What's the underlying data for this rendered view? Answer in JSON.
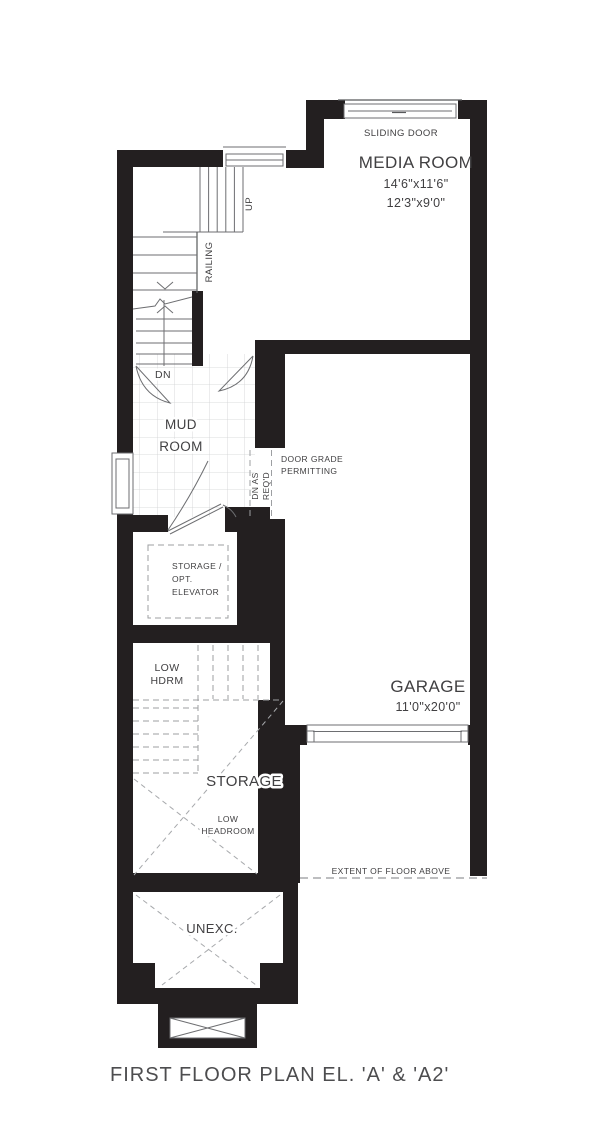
{
  "title": "FIRST FLOOR PLAN EL. 'A' & 'A2'",
  "rooms": {
    "media_room": {
      "name": "MEDIA ROOM",
      "dim1": "14'6\"x11'6\"",
      "dim2": "12'3\"x9'0\""
    },
    "garage": {
      "name": "GARAGE",
      "dim": "11'0\"x20'0\""
    },
    "mud_room": {
      "line1": "MUD",
      "line2": "ROOM"
    },
    "storage": {
      "name": "STORAGE",
      "note1": "LOW",
      "note2": "HEADROOM"
    },
    "storage_elevator": {
      "line1": "STORAGE /",
      "line2": "OPT.",
      "line3": "ELEVATOR"
    },
    "low_hdrm": {
      "line1": "LOW",
      "line2": "HDRM"
    },
    "unexcavated": {
      "name": "UNEXC."
    }
  },
  "annotations": {
    "sliding_door": "SLIDING DOOR",
    "up": "UP",
    "dn": "DN",
    "railing": "RAILING",
    "door_grade_line1": "DOOR GRADE",
    "door_grade_line2": "PERMITTING",
    "dn_as": "DN AS",
    "reqd": "REQ'D",
    "extent_of_floor_above": "EXTENT OF FLOOR ABOVE"
  },
  "colors": {
    "wall": "#231f20",
    "thin_line": "#6d6e71",
    "dashed_line": "#9d9fa2",
    "tile_grid": "#d0d1d3",
    "text": "#414042",
    "background": "#ffffff"
  }
}
